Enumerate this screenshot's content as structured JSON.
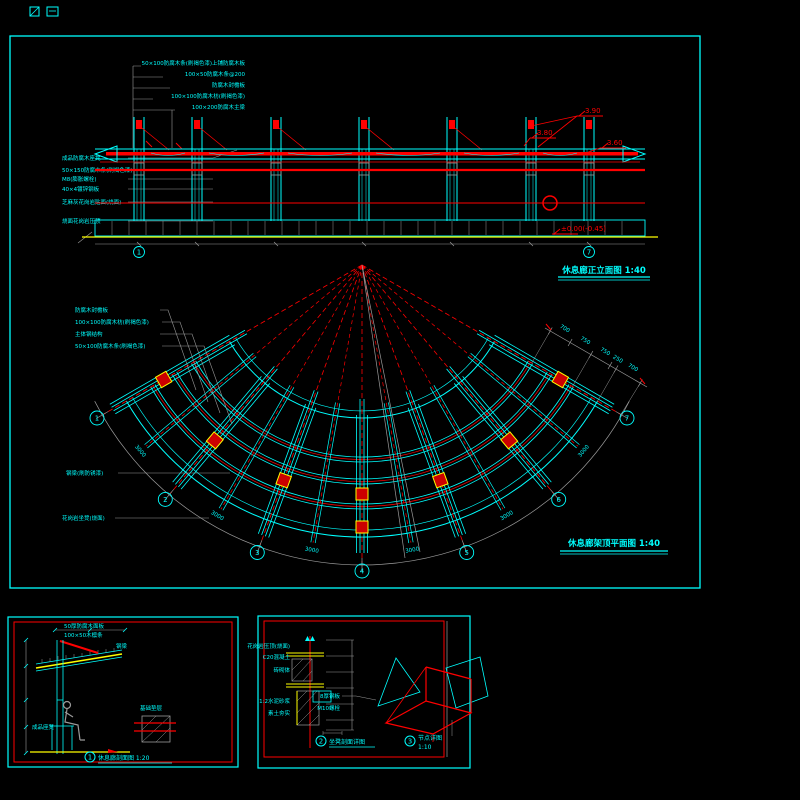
{
  "colors": {
    "background": "#000000",
    "line_primary": "#00ffff",
    "line_highlight": "#ff0000",
    "line_ground": "#ffff00",
    "line_dimension": "#9a9a9a",
    "text_annotation": "#00ffff",
    "text_elevation_mark": "#ff0000"
  },
  "elevation": {
    "title": "休息廊正立面图 1:40",
    "top_labels": [
      "50×100防腐木条(刷褐色漆)上铺防腐木板",
      "100×50防腐木条@200",
      "防腐木封檐板",
      "100×100防腐木枋(刷褐色漆)",
      "100×200防腐木主梁"
    ],
    "left_labels": [
      "成品防腐木座凳",
      "50×150防腐木条(刷褐色漆)",
      "M8(膨胀螺栓)",
      "40×4镀锌钢板",
      "芝麻灰花岗岩贴面(烧面)",
      "烧面花岗岩压顶"
    ],
    "marks": {
      "top": "3.90",
      "mid": "3.80",
      "eave": "3.60",
      "ground": "±0.00(-0.45)"
    },
    "grid_bubbles": {
      "left": "1",
      "right": "7"
    }
  },
  "plan": {
    "title": "休息廊架顶平面图 1:40",
    "left_labels": [
      "防腐木封檐板",
      "100×100防腐木枋(刷褐色漆)",
      "主体钢结构",
      "50×100防腐木条(刷褐色漆)"
    ],
    "beam_label": "钢梁(刷防锈漆)",
    "bench_label": "花岗岩坐凳(烧面)",
    "grid_bubbles": [
      "1",
      "2",
      "3",
      "4",
      "5",
      "6",
      "7"
    ],
    "arc_dims": [
      "3000",
      "3000",
      "3000",
      "3000",
      "3000",
      "3000"
    ],
    "edge_dims": [
      "700",
      "750",
      "750",
      "250",
      "700"
    ]
  },
  "section_panel": {
    "figure_num": "1",
    "title": "休息廊剖面图 1:20",
    "labels": [
      "50厚防腐木面板",
      "100×50木檩条",
      "钢梁",
      "成品座凳",
      "基础垫层"
    ]
  },
  "detail_panel": {
    "left": {
      "figure_num": "2",
      "title": "坐凳剖面详图",
      "labels": [
        "花岗岩压顶(烧面)",
        "C20混凝土",
        "砖砌体",
        "1:2水泥砂浆",
        "素土夯实"
      ]
    },
    "right": {
      "figure_num": "3",
      "title_line1": "节点详图",
      "title_line2": "1:10",
      "labels": [
        "8厚钢板",
        "M10螺栓"
      ]
    }
  }
}
